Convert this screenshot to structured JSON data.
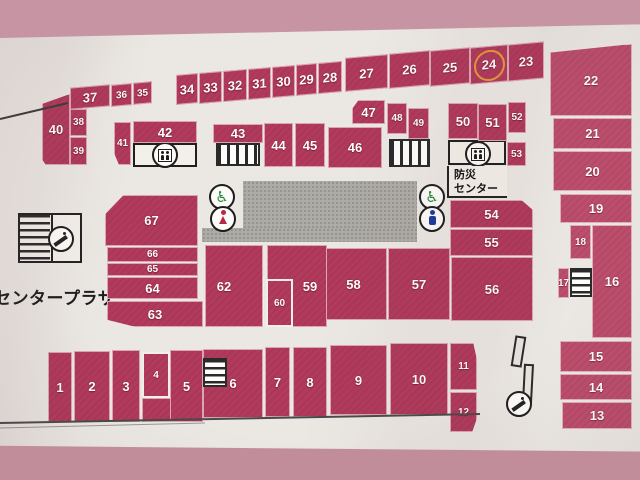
{
  "map_title": "センタープラザ フロアマップ",
  "labels": {
    "center_plaza": "センタープラザ",
    "disaster_center_line1": "防災",
    "disaster_center_line2": "センター"
  },
  "highlighted_unit": "24",
  "highlight_color": "#e09a3a",
  "colors": {
    "unit_fill": "#b23a5c",
    "unit_fill_light": "#bd4e6d",
    "paper": "#ebe8e3",
    "photo_border": "#c694a2",
    "corridor_grey": "#adaba6"
  },
  "icons": {
    "wheelchair": "♿",
    "elevator": "circle-with-two-people",
    "female_restroom": "red-person-dress",
    "male_restroom": "blue-person",
    "escalator": "circle-diagonal-steps",
    "stairs": "striped-box"
  },
  "units": [
    {
      "label": "1",
      "x": 48,
      "y": 352,
      "w": 24,
      "h": 70
    },
    {
      "label": "2",
      "x": 74,
      "y": 351,
      "w": 36,
      "h": 71
    },
    {
      "label": "3",
      "x": 112,
      "y": 350,
      "w": 28,
      "h": 72
    },
    {
      "label": "4",
      "x": 142,
      "y": 352,
      "w": 28,
      "h": 46,
      "cls": "ov small"
    },
    {
      "label": "5",
      "x": 170,
      "y": 350,
      "w": 33,
      "h": 72
    },
    {
      "label": "6",
      "x": 203,
      "y": 349,
      "w": 60,
      "h": 69
    },
    {
      "label": "7",
      "x": 265,
      "y": 347,
      "w": 25,
      "h": 70
    },
    {
      "label": "8",
      "x": 293,
      "y": 347,
      "w": 34,
      "h": 70
    },
    {
      "label": "9",
      "x": 330,
      "y": 345,
      "w": 57,
      "h": 70
    },
    {
      "label": "10",
      "x": 390,
      "y": 343,
      "w": 58,
      "h": 72
    },
    {
      "label": "11",
      "x": 450,
      "y": 343,
      "w": 27,
      "h": 47,
      "cls": "cut-tr small"
    },
    {
      "label": "12",
      "x": 450,
      "y": 392,
      "w": 27,
      "h": 40,
      "cls": "cut-br small"
    },
    {
      "label": "13",
      "x": 562,
      "y": 402,
      "w": 70,
      "h": 27,
      "cls": "lt"
    },
    {
      "label": "14",
      "x": 560,
      "y": 374,
      "w": 72,
      "h": 26,
      "cls": "lt"
    },
    {
      "label": "15",
      "x": 560,
      "y": 341,
      "w": 72,
      "h": 31,
      "cls": "lt"
    },
    {
      "label": "16",
      "x": 592,
      "y": 225,
      "w": 40,
      "h": 113,
      "cls": "lt"
    },
    {
      "label": "17",
      "x": 558,
      "y": 268,
      "w": 11,
      "h": 30,
      "cls": "lt small"
    },
    {
      "label": "18",
      "x": 570,
      "y": 225,
      "w": 21,
      "h": 34,
      "cls": "lt small"
    },
    {
      "label": "19",
      "x": 560,
      "y": 194,
      "w": 72,
      "h": 29,
      "cls": "lt"
    },
    {
      "label": "20",
      "x": 553,
      "y": 151,
      "w": 79,
      "h": 40,
      "cls": "lt"
    },
    {
      "label": "21",
      "x": 553,
      "y": 118,
      "w": 79,
      "h": 31,
      "cls": "lt"
    },
    {
      "label": "22",
      "x": 550,
      "y": 44,
      "w": 82,
      "h": 72,
      "cls": "lt slant-top"
    },
    {
      "label": "23",
      "x": 508,
      "y": 43,
      "w": 36,
      "h": 37,
      "cls": "sk"
    },
    {
      "label": "24",
      "x": 470,
      "y": 46,
      "w": 38,
      "h": 37,
      "cls": "sk",
      "hl": true
    },
    {
      "label": "25",
      "x": 430,
      "y": 49,
      "w": 40,
      "h": 36,
      "cls": "sk"
    },
    {
      "label": "26",
      "x": 389,
      "y": 52,
      "w": 41,
      "h": 35,
      "cls": "sk"
    },
    {
      "label": "27",
      "x": 345,
      "y": 56,
      "w": 43,
      "h": 34,
      "cls": "sk"
    },
    {
      "label": "28",
      "x": 318,
      "y": 62,
      "w": 24,
      "h": 31,
      "cls": "sk"
    },
    {
      "label": "29",
      "x": 296,
      "y": 64,
      "w": 21,
      "h": 31,
      "cls": "sk"
    },
    {
      "label": "30",
      "x": 272,
      "y": 66,
      "w": 23,
      "h": 31,
      "cls": "sk"
    },
    {
      "label": "31",
      "x": 248,
      "y": 68,
      "w": 23,
      "h": 31,
      "cls": "sk"
    },
    {
      "label": "32",
      "x": 223,
      "y": 70,
      "w": 24,
      "h": 31,
      "cls": "sk"
    },
    {
      "label": "33",
      "x": 199,
      "y": 72,
      "w": 23,
      "h": 31,
      "cls": "sk"
    },
    {
      "label": "34",
      "x": 176,
      "y": 74,
      "w": 22,
      "h": 30,
      "cls": "sk"
    },
    {
      "label": "35",
      "x": 133,
      "y": 82,
      "w": 19,
      "h": 22,
      "cls": "sk small"
    },
    {
      "label": "36",
      "x": 111,
      "y": 84,
      "w": 21,
      "h": 22,
      "cls": "sk small"
    },
    {
      "label": "37",
      "x": 70,
      "y": 86,
      "w": 40,
      "h": 22,
      "cls": "sk"
    },
    {
      "label": "38",
      "x": 70,
      "y": 109,
      "w": 17,
      "h": 27,
      "cls": "small"
    },
    {
      "label": "39",
      "x": 70,
      "y": 137,
      "w": 17,
      "h": 28,
      "cls": "small"
    },
    {
      "label": "40",
      "x": 42,
      "y": 94,
      "w": 28,
      "h": 71,
      "cls": "slant-top40"
    },
    {
      "label": "41",
      "x": 114,
      "y": 122,
      "w": 17,
      "h": 43,
      "cls": "cut-bl small"
    },
    {
      "label": "42",
      "x": 133,
      "y": 121,
      "w": 64,
      "h": 22
    },
    {
      "label": "43",
      "x": 213,
      "y": 124,
      "w": 50,
      "h": 19
    },
    {
      "label": "44",
      "x": 264,
      "y": 123,
      "w": 29,
      "h": 44
    },
    {
      "label": "45",
      "x": 295,
      "y": 123,
      "w": 30,
      "h": 44
    },
    {
      "label": "46",
      "x": 328,
      "y": 127,
      "w": 54,
      "h": 41
    },
    {
      "label": "47",
      "x": 352,
      "y": 100,
      "w": 33,
      "h": 24,
      "cls": "cut-tl"
    },
    {
      "label": "48",
      "x": 387,
      "y": 103,
      "w": 20,
      "h": 31,
      "cls": "small"
    },
    {
      "label": "49",
      "x": 408,
      "y": 108,
      "w": 21,
      "h": 31,
      "cls": "small"
    },
    {
      "label": "50",
      "x": 448,
      "y": 103,
      "w": 30,
      "h": 36
    },
    {
      "label": "51",
      "x": 478,
      "y": 104,
      "w": 29,
      "h": 37
    },
    {
      "label": "52",
      "x": 508,
      "y": 102,
      "w": 18,
      "h": 31,
      "cls": "small"
    },
    {
      "label": "53",
      "x": 507,
      "y": 142,
      "w": 19,
      "h": 24,
      "cls": "small"
    },
    {
      "label": "54",
      "x": 450,
      "y": 200,
      "w": 83,
      "h": 28,
      "cls": "cut-tr"
    },
    {
      "label": "55",
      "x": 450,
      "y": 229,
      "w": 83,
      "h": 27
    },
    {
      "label": "56",
      "x": 451,
      "y": 257,
      "w": 82,
      "h": 64
    },
    {
      "label": "57",
      "x": 388,
      "y": 248,
      "w": 62,
      "h": 72
    },
    {
      "label": "58",
      "x": 320,
      "y": 248,
      "w": 67,
      "h": 72
    },
    {
      "label": "59",
      "x": 267,
      "y": 245,
      "w": 60,
      "h": 82,
      "dx": 13
    },
    {
      "label": "60",
      "x": 266,
      "y": 279,
      "w": 27,
      "h": 48,
      "cls": "ov small"
    },
    {
      "label": "61",
      "x": 237,
      "y": 276,
      "w": 27,
      "h": 51,
      "cls": "ov small"
    },
    {
      "label": "62",
      "x": 205,
      "y": 245,
      "w": 58,
      "h": 82,
      "dx": -10
    },
    {
      "label": "63",
      "x": 107,
      "y": 301,
      "w": 96,
      "h": 26,
      "cls": "cut-bl"
    },
    {
      "label": "64",
      "x": 107,
      "y": 277,
      "w": 91,
      "h": 22
    },
    {
      "label": "65",
      "x": 107,
      "y": 263,
      "w": 91,
      "h": 13,
      "cls": "small"
    },
    {
      "label": "66",
      "x": 107,
      "y": 247,
      "w": 91,
      "h": 15,
      "cls": "small"
    },
    {
      "label": "67",
      "x": 105,
      "y": 195,
      "w": 93,
      "h": 51,
      "cls": "cut-tl"
    }
  ],
  "extras": [
    {
      "x": 142,
      "y": 398,
      "w": 30,
      "h": 24
    }
  ],
  "stairs": [
    {
      "dir": "v",
      "x": 216,
      "y": 143,
      "w": 44,
      "h": 23
    },
    {
      "dir": "v",
      "x": 389,
      "y": 139,
      "w": 41,
      "h": 28
    },
    {
      "dir": "h",
      "x": 203,
      "y": 358,
      "w": 24,
      "h": 29
    },
    {
      "dir": "h",
      "x": 570,
      "y": 268,
      "w": 22,
      "h": 29
    }
  ]
}
